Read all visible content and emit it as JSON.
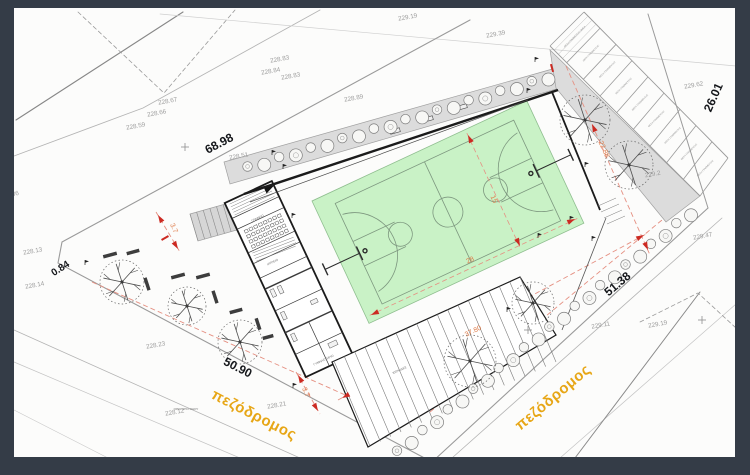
{
  "colors": {
    "frame": "#343c47",
    "sheet": "#fcfcfb",
    "boundary": "#9a9a9a",
    "parcel": "#b8b8b8",
    "building": "#1b1b1b",
    "walkway_gray": "#dcdcdc",
    "court_green": "#c9f2c6",
    "court_line": "#7d977f",
    "red_arrow": "#cc2a22",
    "red_dash": "#e59082",
    "dim_text": "#de7c4a",
    "road_text": "#e7a616",
    "spot_text": "#9b9b9b"
  },
  "spot_elevations": [
    {
      "t": "229.19",
      "x": 408,
      "y": 19
    },
    {
      "t": "229.39",
      "x": 496,
      "y": 36
    },
    {
      "t": "228.83",
      "x": 280,
      "y": 61
    },
    {
      "t": "228.84",
      "x": 271,
      "y": 73
    },
    {
      "t": "228.83",
      "x": 291,
      "y": 78
    },
    {
      "t": "228.89",
      "x": 354,
      "y": 100
    },
    {
      "t": "228.67",
      "x": 168,
      "y": 103
    },
    {
      "t": "228.66",
      "x": 157,
      "y": 115
    },
    {
      "t": "228.59",
      "x": 136,
      "y": 128
    },
    {
      "t": "228.51",
      "x": 239,
      "y": 158
    },
    {
      "t": "228.13",
      "x": 33,
      "y": 253
    },
    {
      "t": "228.14",
      "x": 35,
      "y": 287
    },
    {
      "t": "1.36",
      "x": 13,
      "y": 196
    },
    {
      "t": "228.23",
      "x": 156,
      "y": 347
    },
    {
      "t": "228.21",
      "x": 277,
      "y": 407
    },
    {
      "t": "228.12",
      "x": 175,
      "y": 414
    },
    {
      "t": "229.11",
      "x": 601,
      "y": 327
    },
    {
      "t": "229.19",
      "x": 658,
      "y": 326
    },
    {
      "t": "229.47",
      "x": 703,
      "y": 238
    },
    {
      "t": "229.2",
      "x": 653,
      "y": 176
    },
    {
      "t": "229.62",
      "x": 694,
      "y": 87
    }
  ],
  "boundary_dims": [
    {
      "t": "68.98",
      "x": 221,
      "y": 147,
      "r": -28,
      "cls": "lbl-big"
    },
    {
      "t": "0.84",
      "x": 62,
      "y": 271,
      "r": -33,
      "cls": "lbl-med"
    },
    {
      "t": "50.90",
      "x": 236,
      "y": 371,
      "r": 27,
      "cls": "lbl-big"
    },
    {
      "t": "51.38",
      "x": 620,
      "y": 287,
      "r": -40,
      "cls": "lbl-big"
    },
    {
      "t": "26.01",
      "x": 717,
      "y": 99,
      "r": -66,
      "cls": "lbl-big"
    }
  ],
  "road_labels": [
    {
      "t": "πεζόδρομος",
      "x": 252,
      "y": 419,
      "r": 27
    },
    {
      "t": "πεζόδρομος",
      "x": 556,
      "y": 401,
      "r": -40
    }
  ],
  "dim_labels": [
    {
      "t": "22.88",
      "x": 602,
      "y": 150,
      "r": 66
    },
    {
      "t": "37.80",
      "x": 474,
      "y": 333,
      "r": -26
    },
    {
      "t": "28",
      "x": 471,
      "y": 262,
      "r": -25
    },
    {
      "t": "15",
      "x": 492,
      "y": 200,
      "r": 66
    },
    {
      "t": "3.7",
      "x": 172,
      "y": 229,
      "r": 66
    },
    {
      "t": "3.7",
      "x": 304,
      "y": 393,
      "r": 66
    }
  ],
  "room_labels": [
    {
      "t": "ΓΡΑΦΕΙΟ",
      "x": 258,
      "y": 219,
      "r": -25
    },
    {
      "t": "ΙΑΤΡΕΙΟ",
      "x": 273,
      "y": 263,
      "r": -25
    },
    {
      "t": "ΓΥΜΝΑΣΤΗΡΙΟ",
      "x": 324,
      "y": 361,
      "r": -25
    },
    {
      "t": "ΚΕΡΚΙΔΕΣ",
      "x": 400,
      "y": 371,
      "r": -24
    },
    {
      "t": "ΟΡΙΟ ΑΠΟ ΟΔΟΥ",
      "x": 186,
      "y": 410,
      "r": 0
    }
  ],
  "parking": {
    "stall_label": "ΘΕΣΗ ΣΤΑΘΜΕΥΣΗΣ",
    "ada_label": "ΑΜΕΑ",
    "inner": [
      [
        550,
        46
      ],
      [
        700,
        196
      ]
    ],
    "outer": [
      [
        584,
        12
      ],
      [
        728,
        158
      ]
    ],
    "stalls": 9
  },
  "trees": [
    [
      122,
      282,
      22
    ],
    [
      187,
      306,
      19
    ],
    [
      240,
      342,
      22
    ],
    [
      470,
      361,
      26
    ],
    [
      585,
      120,
      25
    ],
    [
      629,
      165,
      24
    ],
    [
      533,
      303,
      21
    ]
  ],
  "shrub_rows": [
    {
      "a": [
        248,
        168
      ],
      "b": [
        548,
        78
      ],
      "n": 20
    },
    {
      "a": [
        398,
        452
      ],
      "b": [
        690,
        214
      ],
      "n": 24
    }
  ],
  "benches": [
    [
      110,
      255,
      -15,
      14
    ],
    [
      133,
      252,
      -15,
      13
    ],
    [
      178,
      276,
      -15,
      14
    ],
    [
      203,
      276,
      -15,
      14
    ],
    [
      147,
      284,
      72,
      13
    ],
    [
      215,
      297,
      72,
      13
    ],
    [
      236,
      311,
      -15,
      13
    ],
    [
      258,
      324,
      72,
      12
    ],
    [
      268,
      337,
      -15,
      11
    ]
  ],
  "markers": [
    [
      272,
      155
    ],
    [
      283,
      169
    ],
    [
      292,
      218
    ],
    [
      535,
      62
    ],
    [
      527,
      93
    ],
    [
      585,
      167
    ],
    [
      570,
      221
    ],
    [
      592,
      241
    ],
    [
      538,
      238
    ],
    [
      507,
      312
    ],
    [
      293,
      388
    ],
    [
      85,
      265
    ]
  ],
  "crosses": [
    [
      185,
      147
    ],
    [
      702,
      320
    ],
    [
      528,
      330
    ]
  ],
  "red_ticks": [
    [
      552,
      68,
      -16
    ],
    [
      165,
      238,
      60
    ]
  ],
  "red_dashed": [
    [
      566,
      66,
      650,
      255
    ],
    [
      338,
      400,
      648,
      233
    ],
    [
      156,
      212,
      180,
      252
    ],
    [
      296,
      372,
      320,
      414
    ],
    [
      92,
      282,
      352,
      398
    ],
    [
      430,
      412,
      662,
      220
    ]
  ],
  "red_arrows": [
    [
      371,
      315,
      155
    ],
    [
      575,
      219,
      -25
    ],
    [
      468,
      135,
      -115
    ],
    [
      520,
      246,
      65
    ],
    [
      592,
      124,
      -114
    ],
    [
      648,
      250,
      66
    ],
    [
      342,
      398,
      152
    ],
    [
      644,
      235,
      -28
    ],
    [
      158,
      215,
      239
    ],
    [
      178,
      249,
      59
    ],
    [
      298,
      375,
      240
    ],
    [
      318,
      411,
      60
    ]
  ],
  "ext_stairs": {
    "a": [
      190,
      214
    ],
    "b": [
      243,
      199
    ],
    "c": [
      198,
      241
    ],
    "d": [
      251,
      226
    ],
    "n": 8
  },
  "bleachers": {
    "a": [
      334,
      361
    ],
    "b": [
      520,
      277
    ],
    "off": [
      36,
      85
    ],
    "n": 18
  },
  "seat_grid": {
    "x0": -74,
    "y0": -2,
    "cols": 8,
    "rows": 4,
    "dx": 5.2,
    "dy": 5.6,
    "w": 3.4,
    "h": 3
  }
}
